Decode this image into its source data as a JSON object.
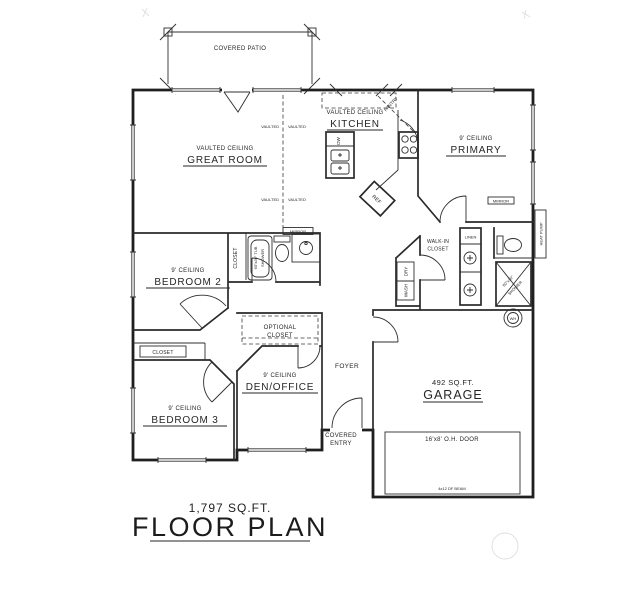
{
  "plan": {
    "title_sqft": "1,797  SQ.FT.",
    "title": "FLOOR PLAN"
  },
  "rooms": {
    "covered_patio": "COVERED PATIO",
    "great_room_ceiling": "VAULTED CEILING",
    "great_room": "GREAT ROOM",
    "kitchen_ceiling": "VAULTED CEILING",
    "kitchen": "KITCHEN",
    "primary_ceiling": "9' CEILING",
    "primary": "PRIMARY",
    "bedroom2_ceiling": "9' CEILING",
    "bedroom2": "BEDROOM 2",
    "bedroom3_ceiling": "9' CEILING",
    "bedroom3": "BEDROOM 3",
    "den_ceiling": "9' CEILING",
    "den": "DEN/OFFICE",
    "foyer": "FOYER",
    "covered_entry_1": "COVERED",
    "covered_entry_2": "ENTRY",
    "garage_sqft": "492  SQ.FT.",
    "garage": "GARAGE",
    "walk_in_1": "WALK-IN",
    "walk_in_2": "CLOSET",
    "optional_closet_1": "OPTIONAL",
    "optional_closet_2": "CLOSET",
    "closet_b2": "CLOSET",
    "closet_b3": "CLOSET",
    "pantry": "PANTRY"
  },
  "fixtures": {
    "ref": "REF",
    "dw": "DW",
    "wash": "WASH",
    "dry": "DRY",
    "linen": "LINEN",
    "wh": "WH",
    "heat_pump": "HEAT PUMP",
    "mirror_hall": "MIRROR",
    "mirror_primary": "MIRROR",
    "tub_1": "60\"x36\" TUB",
    "tub_2": "SHOWER",
    "shower_1": "60\"x30\"",
    "shower_2": "SHOWER",
    "vaulted": "VAULTED",
    "garage_door": "16'x8' O.H. DOOR",
    "garage_beam": "4x12 DF BEAM"
  },
  "colors": {
    "ink": "#2a2a2a",
    "paper": "#ffffff"
  }
}
